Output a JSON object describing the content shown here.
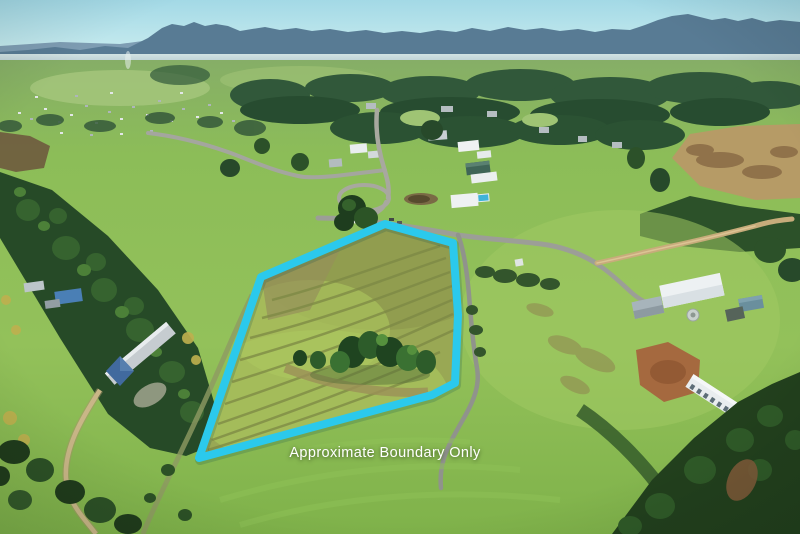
{
  "annotation": {
    "caption": "Approximate Boundary Only",
    "caption_color": "#ffffff",
    "boundary_color": "#2bc9ec",
    "boundary_stroke_width": "8",
    "boundary_points": "385,224 453,243 458,315 455,383 432,395 199,458 261,277"
  },
  "palette": {
    "sky_top": "#a3d9e6",
    "sky_horizon": "#e4f3f0",
    "mountains": "#587b94",
    "mountains_far": "#7e9db3",
    "distant_forest": "#2e5435",
    "field_bright_green": "#8cbd58",
    "property_olive_grass": "#99a854",
    "sealed_road_gray": "#9c9e97",
    "dirt_road_tan": "#c7ac7b",
    "roof_white": "#edf1f3",
    "roof_blue": "#41679a",
    "pool_blue": "#3fb3d9",
    "dirt_patch_brown": "#a5693f",
    "shadow_trees": "#22401d"
  }
}
